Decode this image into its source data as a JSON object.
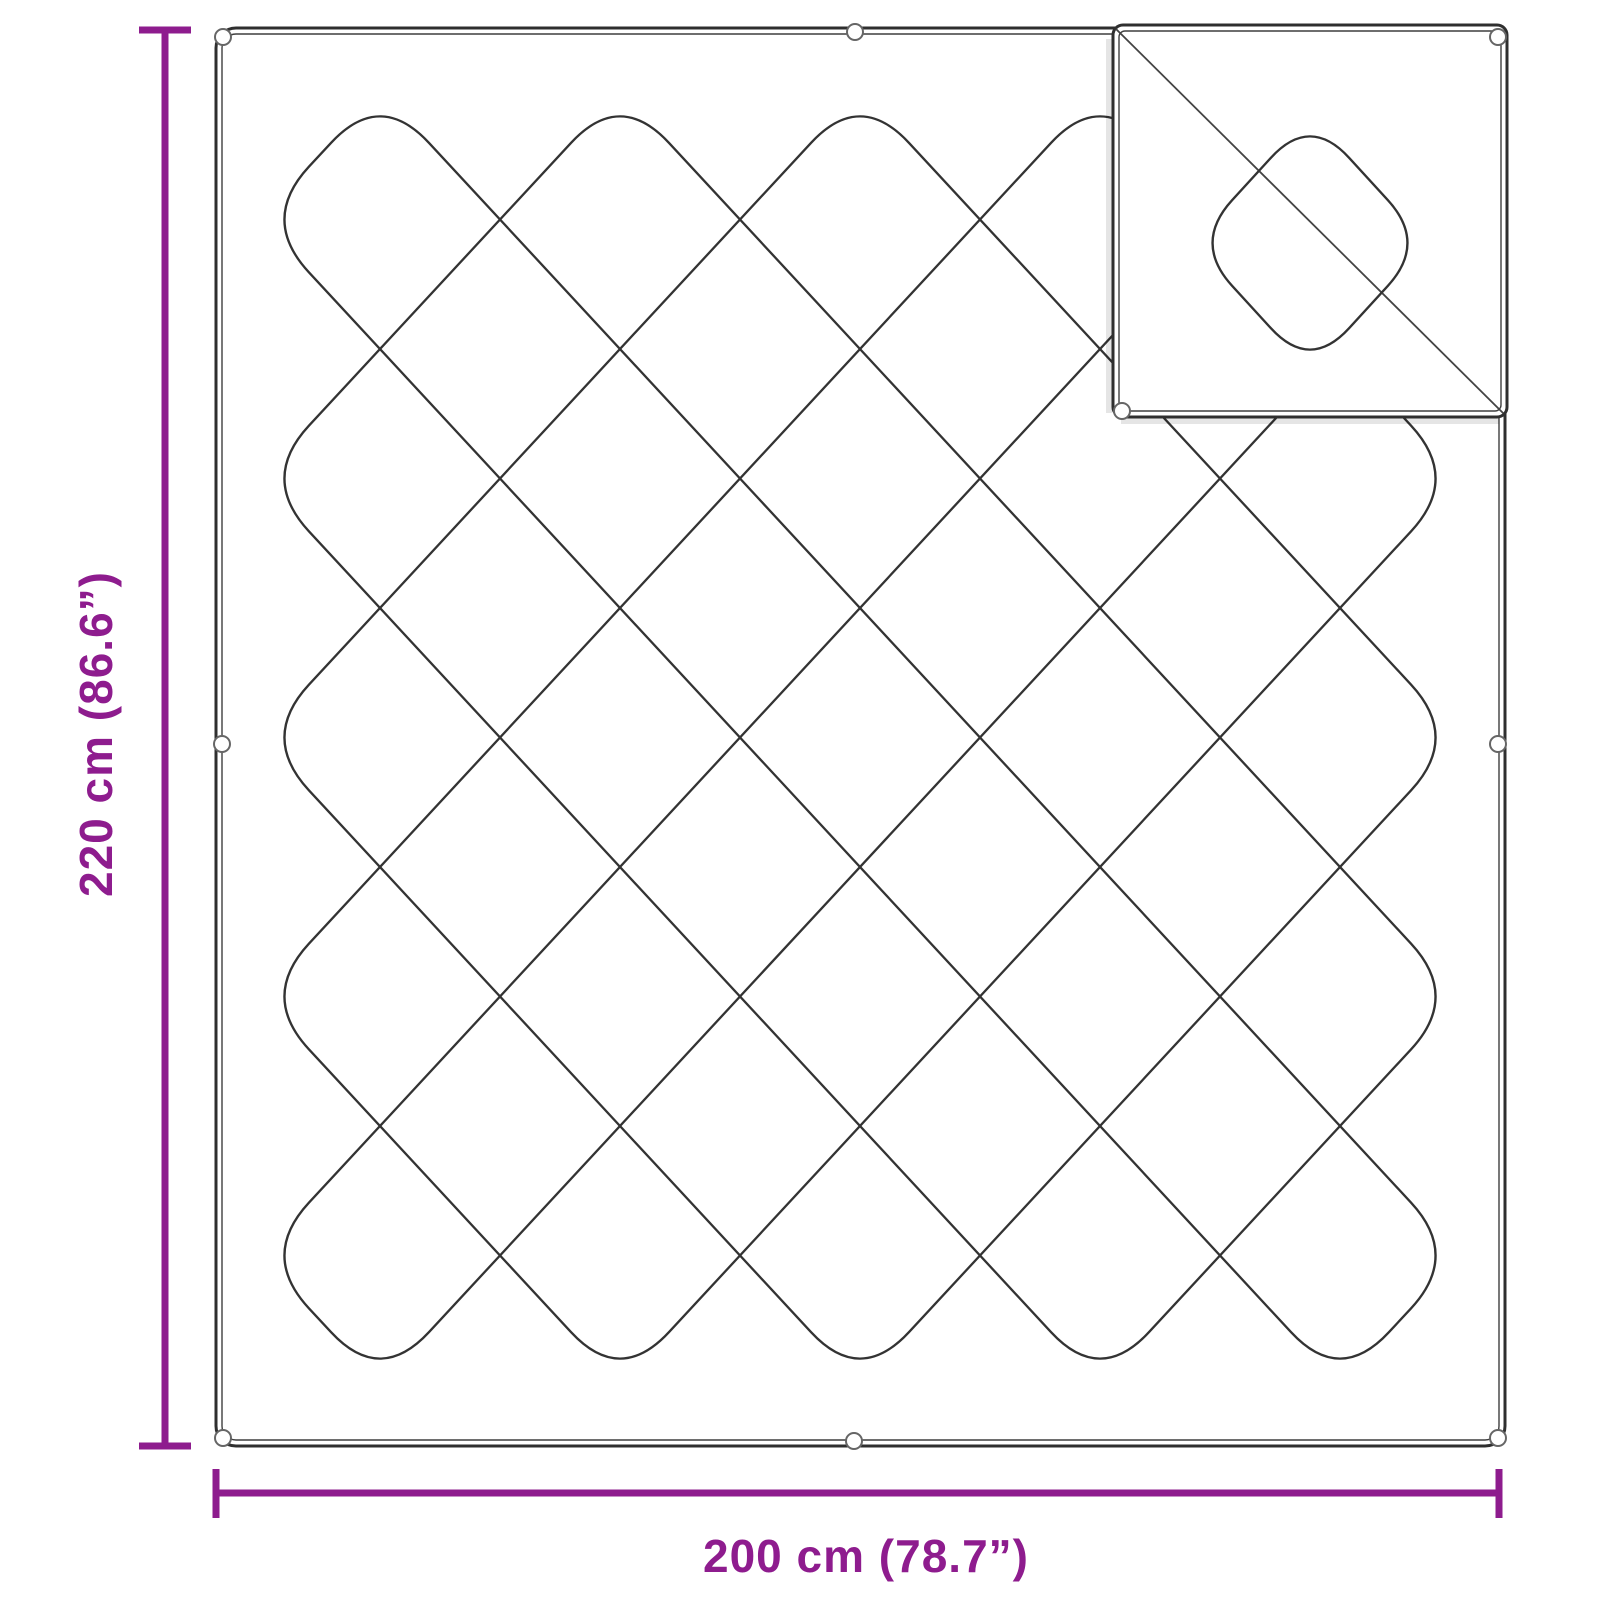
{
  "page": {
    "background": "#ffffff",
    "description_label": "Blanket dimension diagram"
  },
  "diagram": {
    "line_color": "#2f2f2f",
    "stitch_color": "#333333",
    "grommet_color": "#666666",
    "accent_color": "#8E1C8E",
    "blanket": {
      "x": 216,
      "y": 28,
      "w": 1289,
      "h": 1418,
      "corner_radius": 20,
      "inner_offset": 6,
      "outer_stroke": 3,
      "inner_stroke": 1.4
    },
    "pattern": {
      "bx": 260,
      "by": 90,
      "cell_w": 120,
      "cell_h": 129.5,
      "nx": 10,
      "ny": 10,
      "loops": [
        1,
        3,
        5,
        7,
        9
      ],
      "corner_trim": 72,
      "stroke_w": 2.3
    },
    "flap": {
      "x": 1113,
      "y": 25,
      "w": 394,
      "h": 392,
      "corner_radius": 10,
      "inner_offset": 6,
      "diagonal": {
        "x1": 1116,
        "y1": 29,
        "x2": 1503,
        "y2": 413
      },
      "diamond": {
        "cx": 1310,
        "cy": 243,
        "rx": 117,
        "ry": 128,
        "corner_trim": 58
      }
    },
    "grommets": {
      "r": 8,
      "stroke_w": 2,
      "positions": [
        [
          223,
          37
        ],
        [
          855,
          32
        ],
        [
          222,
          744
        ],
        [
          1498,
          744
        ],
        [
          223,
          1438
        ],
        [
          854,
          1441
        ],
        [
          1498,
          1438
        ],
        [
          1498,
          37
        ],
        [
          1122,
          411
        ]
      ]
    },
    "dimensions": {
      "stroke_w": 7,
      "height": {
        "label": "220 cm (86.6”)",
        "line_x": 165,
        "y1": 27,
        "y2": 1449,
        "cap_from": 139,
        "cap_to": 191,
        "label_x": 112,
        "label_y": 734
      },
      "width": {
        "label": "200 cm (78.7”)",
        "line_y": 1493,
        "x1": 218,
        "x2": 1497,
        "cap_from": 1469,
        "cap_to": 1518,
        "label_x": 866,
        "label_y": 1572
      }
    }
  }
}
